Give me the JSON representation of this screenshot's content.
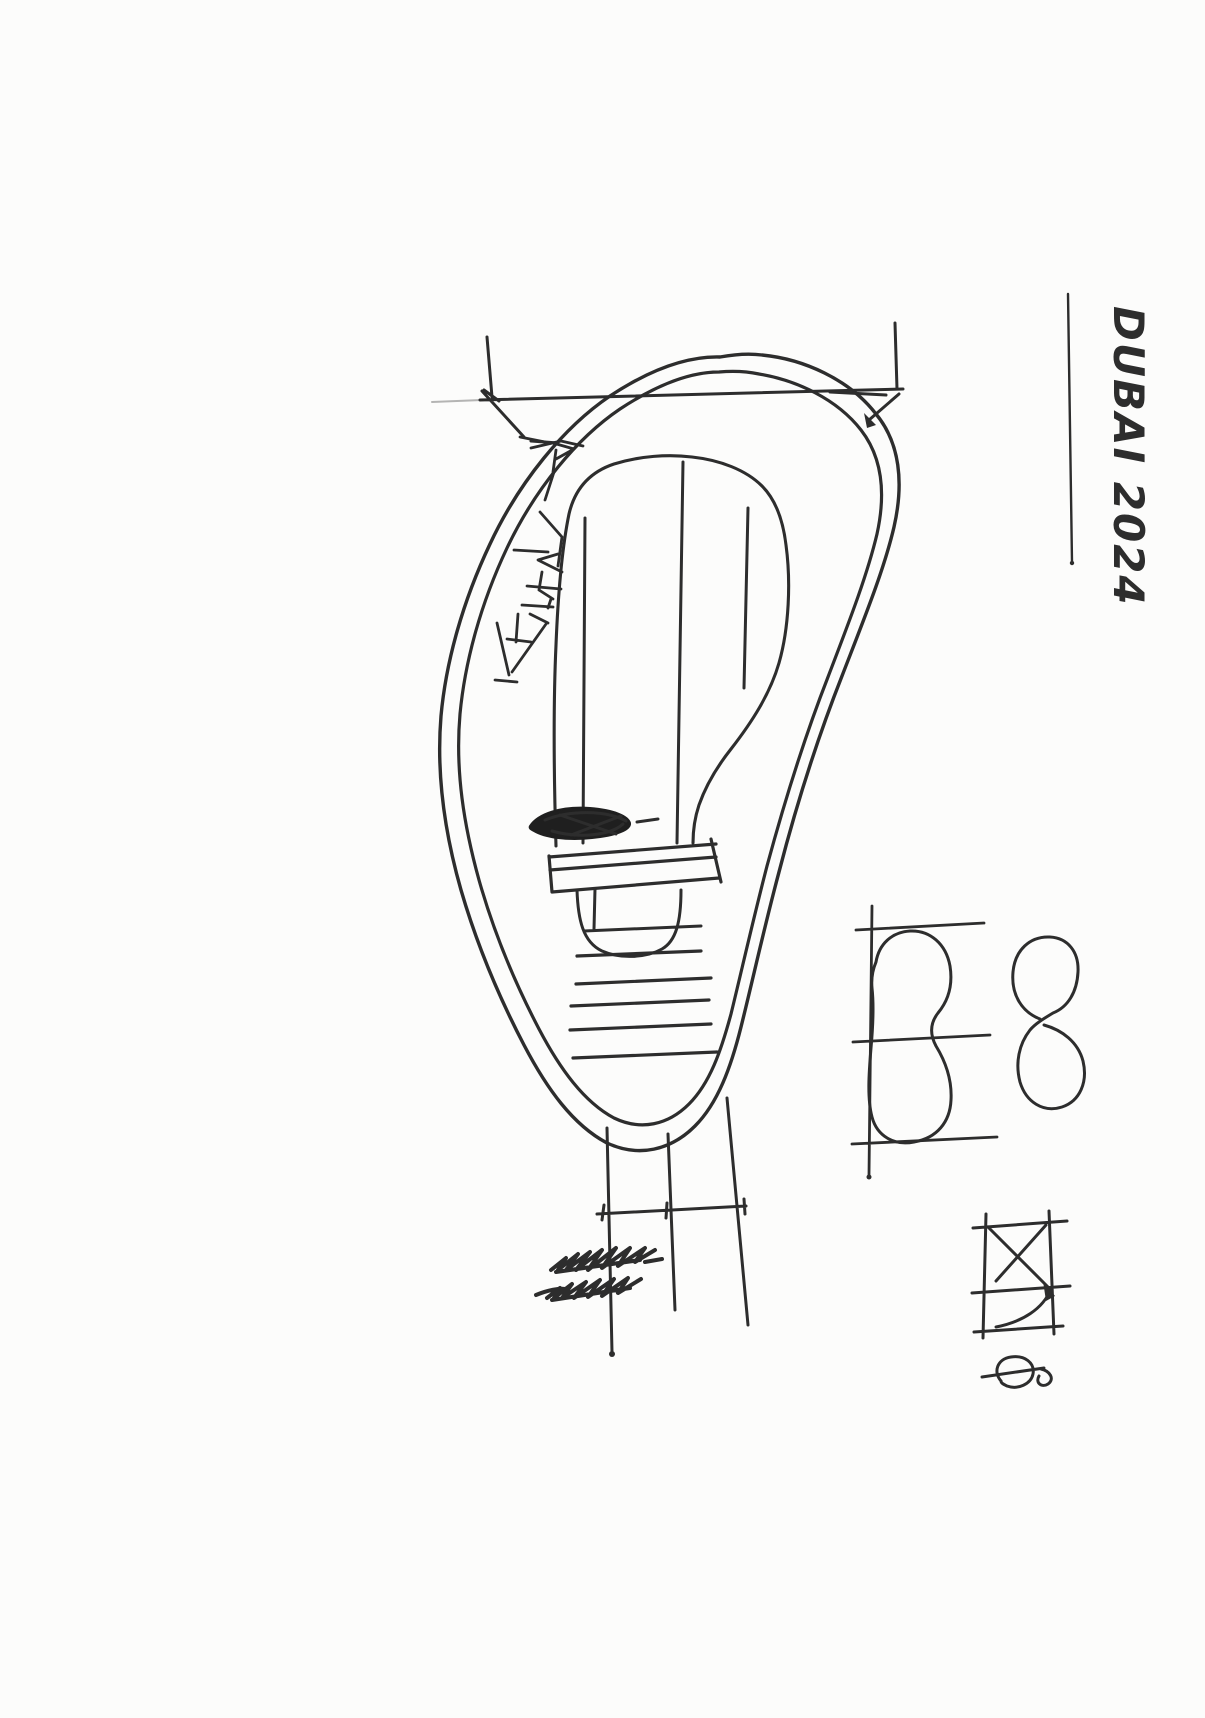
{
  "page": {
    "type": "hand-drawn pen sketch on white paper",
    "background_color": "#fcfcfb",
    "ink_color": "#2d2d2d"
  },
  "annotation": {
    "text": "DUBAI 2024",
    "orientation": "rotated-90-clockwise",
    "underlined": true
  },
  "figures": {
    "main_sketch": "light-bulb-outline-with-dimension-leaders",
    "side_sketches": [
      "peanut-outline-with-guide-lines",
      "figure-eight-outline",
      "crossed-square-with-arc",
      "phi-diameter-symbol"
    ]
  }
}
